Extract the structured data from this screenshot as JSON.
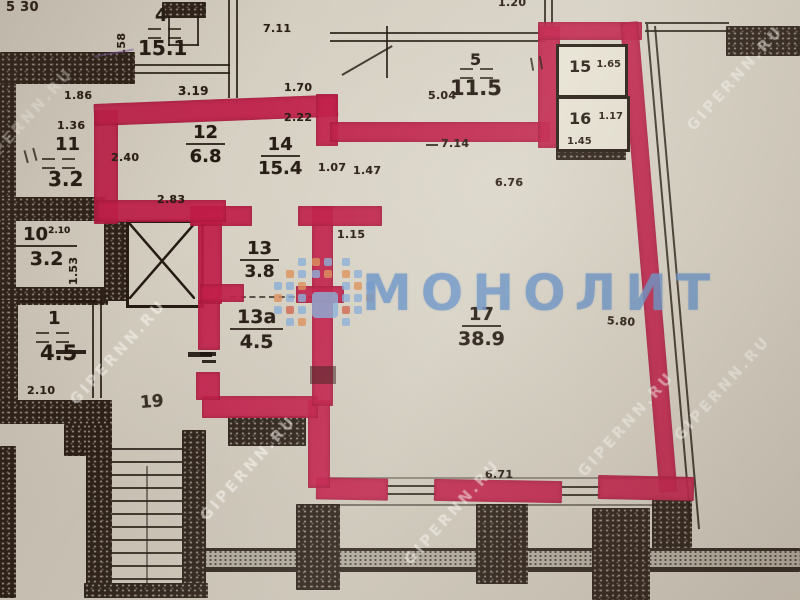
{
  "watermarks": {
    "brand": "МОНОЛИТ",
    "site": "GIPERNN.RU"
  },
  "rooms": {
    "4": {
      "number": "4",
      "area": "15.1"
    },
    "5": {
      "number": "5",
      "area": "11.5"
    },
    "10": {
      "number": "10",
      "area": "3.2",
      "height_note": "2.10"
    },
    "11": {
      "number": "11",
      "area": "3.2"
    },
    "1": {
      "number": "1",
      "area": "4.5"
    },
    "12": {
      "number": "12",
      "area": "6.8"
    },
    "13": {
      "number": "13",
      "area": "3.8"
    },
    "13a": {
      "number": "13a",
      "area": "4.5"
    },
    "14": {
      "number": "14",
      "area": "15.4"
    },
    "15": {
      "number": "15",
      "width": "1.65"
    },
    "16": {
      "number": "16",
      "width": "1.17",
      "depth": "1.45"
    },
    "17": {
      "number": "17",
      "area": "38.9"
    },
    "19": {
      "number": "19"
    }
  },
  "dims": {
    "top_left": "5 30",
    "top_center": "1.20",
    "w711": "7.11",
    "w319": "3.19",
    "w186": "1.86",
    "w136": "1.36",
    "w170": "1.70",
    "w222": "2.22",
    "w240": "2.40",
    "w283": "2.83",
    "w107": "1.07",
    "w147": "1.47",
    "w504": "5.04",
    "w714": "7.14",
    "w676": "6.76",
    "w115": "1.15",
    "w580": "5.80",
    "w671": "6.71",
    "w210": "2.10",
    "w153": "1.53",
    "w358": "3.58"
  },
  "colors": {
    "paper": "#d7d1c3",
    "apartment_outline_red": "#c01d48",
    "walls_ink": "#2c2017",
    "brand_blue": "#6891c4"
  }
}
